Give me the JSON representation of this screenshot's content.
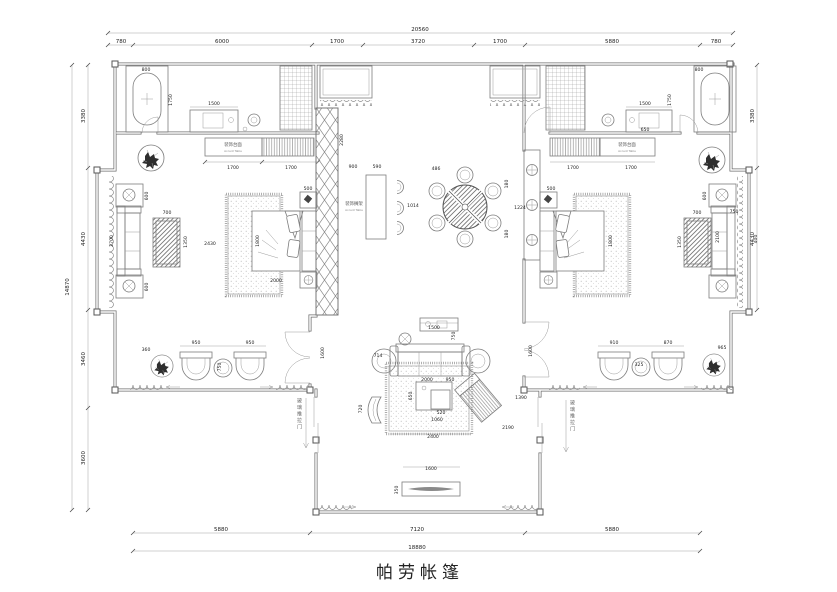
{
  "title": "帕劳帐篷",
  "colors": {
    "wall": "#6e6e6e",
    "furniture": "#7d7d7d",
    "dim_text": "#1c1c1c",
    "background": "#ffffff"
  },
  "labels": {
    "accent_table_left": {
      "cn": "装饰台面",
      "en": "Accent Table"
    },
    "accent_table_right": {
      "cn": "装饰台面",
      "en": "Accent Table"
    },
    "screen_shelf": {
      "cn": "装饰搁架",
      "en": "Accent Table"
    },
    "sliding_door_left": "玻璃推拉门",
    "sliding_door_right": "玻璃推拉门"
  },
  "dimensions": {
    "top_overall": "20560",
    "top": [
      "780",
      "6000",
      "1700",
      "3720",
      "1700",
      "5880",
      "780"
    ],
    "bottom": [
      "5880",
      "7120",
      "5880"
    ],
    "bottom_overall": "18880",
    "left": [
      "3380",
      "4430",
      "3460",
      "3600"
    ],
    "left_overall": "14870",
    "right": [
      "3380",
      "4430"
    ],
    "interior": {
      "tub_l_w": "800",
      "tub_l_h": "1750",
      "dresser_l": "1500",
      "cab_l_a": "1700",
      "cab_l_b": "1700",
      "bed_l_w": "2430",
      "bed_l_h": "1800",
      "bed_l_len": "2000",
      "ctable_l_w": "700",
      "ctable_l_h": "1350",
      "sofa_l": "2700",
      "side_l_a": "600",
      "side_l_b": "600",
      "screen_l": "2280",
      "bar_a": "900",
      "bar_b": "590",
      "chair_top": "486",
      "bar_gap": "1014",
      "table_gap": "1224",
      "shelf_a": "180",
      "shelf_b": "180",
      "ns_l": "500",
      "ns_r": "500",
      "dresser_r": "1500",
      "tub_r_w": "800",
      "tub_r_h": "1750",
      "cab_r_a": "1700",
      "cab_r_b": "1700",
      "door_r": "650",
      "bed_r_h": "1800",
      "ctable_r_w": "700",
      "ctable_r_h": "1350",
      "sofa_r": "2100",
      "sofa_r_d": "750",
      "niche_r": "400",
      "side_r": "600",
      "patio_l_c1": "950",
      "patio_l_c2": "950",
      "patio_l_t": "750",
      "plant_l": "360",
      "patio_r_c1": "910",
      "patio_r_c2": "870",
      "patio_r_t": "325",
      "plant_r": "965",
      "slide_l": "1600",
      "slide_r": "1600",
      "console": "1500",
      "console_d": "750",
      "chair_a": "714",
      "sofa_c_w": "2000",
      "sofa_c_d": "950",
      "ctable_c": "650",
      "ctable_c_b": "520",
      "ctable_c_w": "1060",
      "chaise": "720",
      "lounge_a": "1390",
      "lounge_b": "2190",
      "rug_w": "2400",
      "bench": "1600",
      "bench_d": "350"
    }
  }
}
